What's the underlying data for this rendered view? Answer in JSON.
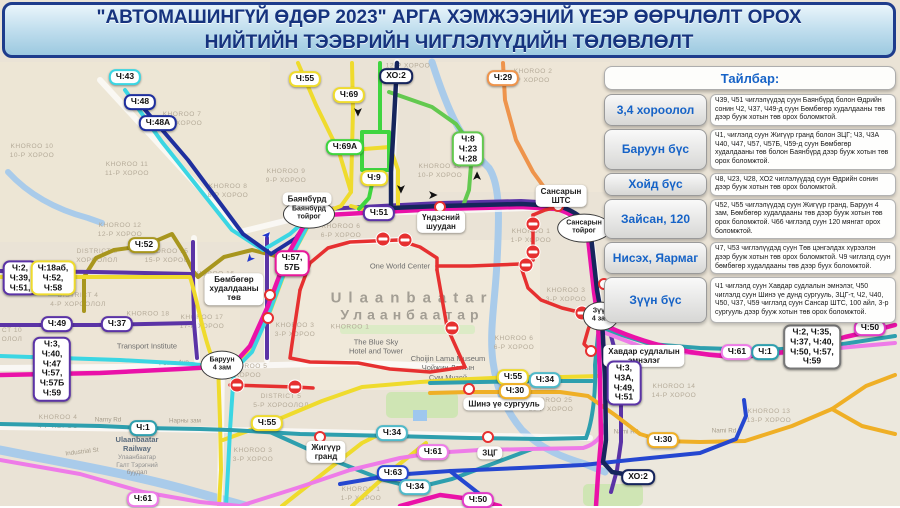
{
  "title": {
    "line1": "\"АВТОМАШИНГҮЙ ӨДӨР 2023\" АРГА ХЭМЖЭЭНИЙ ҮЕЭР ӨӨРЧЛӨЛТ ОРОХ",
    "line2": "НИЙТИЙН ТЭЭВРИЙН ЧИГЛЭЛҮҮДИЙН ТӨЛӨВЛӨЛТ"
  },
  "legend": {
    "header": "Тайлбар:",
    "rows": [
      {
        "label": "3,4 хороолол",
        "text": "Ч39, Ч51 чиглэлүүдэд суун Баянбүрд болон Өдрийн сонин Ч2, Ч37, Ч49-д суун Бөмбөгөр худалдааны төв дээр бууж хотын төв орох боломжтой."
      },
      {
        "label": "Баруун бүс",
        "text": "Ч1, чиглэлд суун Жигүүр гранд болон ЗЦГ; Ч3, Ч3А Ч40, Ч47, Ч57, Ч57Б, Ч59-д суун Бөмбөгөр худалдааны төв болон Баянбүрд дээр бууж хотын төв орох боломжтой."
      },
      {
        "label": "Хойд бүс",
        "text": "Ч8, Ч23, Ч28, ХО2 чиглэлүүдэд суун Өдрийн сонин дээр бууж хотын төв орох боломжтой."
      },
      {
        "label": "Зайсан, 120",
        "text": "Ч52, Ч55 чиглэлүүдэд суун Жигүүр гранд, Баруун 4 зам, Бөмбөгөр худалдааны төв дээр бууж хотын төв орох боломжтой. Ч66 чиглэлд суун 120 мянгат орох боломжтой."
      },
      {
        "label": "Нисэх, Яармаг",
        "text": "Ч7, Ч53 чиглэлүүдэд суун Төв цэнгэлдэх хүрээлэн дээр бууж хотын төв орох боломжтой. Ч9 чиглэлд суун бөмбөгөр худалдааны төв дээр буух боломжтой."
      },
      {
        "label": "Зүүн бүс",
        "text": "Ч1 чиглэлд суун Хавдар судлалын эмнэлэг, Ч50 чиглэлд суун Шинэ үе дунд сургууль, ЗЦГ-т, Ч2, Ч40, Ч50, Ч37, Ч59 чиглэлд суун Сансар ШТС, 100 айл, 3-р сургууль дээр бууж хотын төв орох боломжтой."
      }
    ]
  },
  "map": {
    "city": {
      "en": "Ulaanbaatar",
      "mn": "Улаанбаатар",
      "x": 412,
      "y": 306
    },
    "route_colors": {
      "Ч43": "#3BD6E3",
      "Ч48": "#1F2F9E",
      "Ч48А": "#1F2F9E",
      "Ч55": "#EFDB2D",
      "Ч69": "#EFDB2D",
      "ХО2": "#16255C",
      "Ч29": "#EE944C",
      "Ч69А": "#3FD53F",
      "Ч8-Ч23-Ч28": "#63C94F",
      "Ч9": "#EFDB2D",
      "Ч51": "#5B33A6",
      "Ч52": "#A8961E",
      "Ч57-57Б": "#E8189A",
      "Ч1": "#2E9FAE",
      "Ч34": "#4FB9C9",
      "Ч61": "#EE7BE8",
      "Ч30": "#EFAF26",
      "Ч63": "#2547D0",
      "Ч50": "#E23CC8",
      "restricted_zone": "#E63030",
      "river": "#A9CBEA",
      "map_bg": "#EAE3D6",
      "legend_label": "#1663C7",
      "title_text": "#16337E"
    },
    "route_badges": [
      {
        "label": "Ч:43",
        "lines": [
          "Ч:43"
        ],
        "color": "#3BD6E3",
        "x": 125,
        "y": 77
      },
      {
        "label": "Ч:48",
        "lines": [
          "Ч:48"
        ],
        "color": "#1F2F9E",
        "x": 140,
        "y": 102
      },
      {
        "label": "Ч:48А",
        "lines": [
          "Ч:48А"
        ],
        "color": "#1F2F9E",
        "x": 158,
        "y": 123
      },
      {
        "label": "Ч:55",
        "lines": [
          "Ч:55"
        ],
        "color": "#EFDB2D",
        "x": 305,
        "y": 79
      },
      {
        "label": "Ч:69",
        "lines": [
          "Ч:69"
        ],
        "color": "#EFDB2D",
        "x": 349,
        "y": 95
      },
      {
        "label": "ХО:2",
        "lines": [
          "ХО:2"
        ],
        "color": "#16255C",
        "x": 396,
        "y": 76
      },
      {
        "label": "Ч:29",
        "lines": [
          "Ч:29"
        ],
        "color": "#EE944C",
        "x": 503,
        "y": 78
      },
      {
        "label": "Ч:69А",
        "lines": [
          "Ч:69А"
        ],
        "color": "#3FD53F",
        "x": 345,
        "y": 147
      },
      {
        "label": "Ч:9",
        "lines": [
          "Ч:9"
        ],
        "color": "#EFDB2D",
        "x": 374,
        "y": 178
      },
      {
        "label": "Ч:8 Ч:23 Ч:28",
        "lines": [
          "Ч:8",
          "Ч:23",
          "Ч:28"
        ],
        "color": "#63C94F",
        "x": 468,
        "y": 149
      },
      {
        "label": "Ч:51",
        "lines": [
          "Ч:51"
        ],
        "color": "#5B33A6",
        "x": 379,
        "y": 213
      },
      {
        "label": "Ч:52",
        "lines": [
          "Ч:52"
        ],
        "color": "#A8961E",
        "x": 144,
        "y": 245
      },
      {
        "label": "Ч:2 Ч:39 Ч:51",
        "lines": [
          "Ч:2,",
          "Ч:39,",
          "Ч:51,"
        ],
        "color": "#5B33A6",
        "x": 20,
        "y": 278
      },
      {
        "label": "Ч:18аб Ч:52 Ч:58",
        "lines": [
          "Ч:18аб,",
          "Ч:52,",
          "Ч:58"
        ],
        "color": "#EFDB2D",
        "x": 53,
        "y": 278
      },
      {
        "label": "Ч:57 57Б",
        "lines": [
          "Ч:57,",
          "57Б"
        ],
        "color": "#E8189A",
        "x": 292,
        "y": 263
      },
      {
        "label": "Ч:49",
        "lines": [
          "Ч:49"
        ],
        "color": "#5B33A6",
        "x": 57,
        "y": 324
      },
      {
        "label": "Ч:37",
        "lines": [
          "Ч:37"
        ],
        "color": "#5B33A6",
        "x": 117,
        "y": 324
      },
      {
        "label": "Ч:3 Ч:40 Ч:47 Ч:57 Ч:57Б Ч:59",
        "lines": [
          "Ч:3,",
          "Ч:40,",
          "Ч:47",
          "Ч:57,",
          "Ч:57Б",
          "Ч:59"
        ],
        "color": "#5B33A6",
        "x": 52,
        "y": 369
      },
      {
        "label": "Ч:1",
        "lines": [
          "Ч:1"
        ],
        "color": "#2E9FAE",
        "x": 143,
        "y": 428
      },
      {
        "label": "Ч:55",
        "lines": [
          "Ч:55"
        ],
        "color": "#EFDB2D",
        "x": 267,
        "y": 423
      },
      {
        "label": "Ч:34",
        "lines": [
          "Ч:34"
        ],
        "color": "#4FB9C9",
        "x": 392,
        "y": 433
      },
      {
        "label": "Ч:61",
        "lines": [
          "Ч:61"
        ],
        "color": "#EE7BE8",
        "x": 433,
        "y": 452
      },
      {
        "label": "Ч:63",
        "lines": [
          "Ч:63"
        ],
        "color": "#2547D0",
        "x": 393,
        "y": 473
      },
      {
        "label": "Ч:34",
        "lines": [
          "Ч:34"
        ],
        "color": "#4FB9C9",
        "x": 415,
        "y": 487
      },
      {
        "label": "Ч:50",
        "lines": [
          "Ч:50"
        ],
        "color": "#E23CC8",
        "x": 478,
        "y": 500
      },
      {
        "label": "Ч:61",
        "lines": [
          "Ч:61"
        ],
        "color": "#EE7BE8",
        "x": 143,
        "y": 499
      },
      {
        "label": "Ч:55",
        "lines": [
          "Ч:55"
        ],
        "color": "#EFDB2D",
        "x": 513,
        "y": 377
      },
      {
        "label": "Ч:34",
        "lines": [
          "Ч:34"
        ],
        "color": "#4FB9C9",
        "x": 545,
        "y": 380
      },
      {
        "label": "Ч:30",
        "lines": [
          "Ч:30"
        ],
        "color": "#EFAF26",
        "x": 515,
        "y": 391
      },
      {
        "label": "Ч:30",
        "lines": [
          "Ч:30"
        ],
        "color": "#EFAF26",
        "x": 663,
        "y": 440
      },
      {
        "label": "ХО:2",
        "lines": [
          "ХО:2"
        ],
        "color": "#16255C",
        "x": 638,
        "y": 477
      },
      {
        "label": "Ч:61",
        "lines": [
          "Ч:61"
        ],
        "color": "#EE7BE8",
        "x": 737,
        "y": 352
      },
      {
        "label": "Ч:1",
        "lines": [
          "Ч:1"
        ],
        "color": "#2E9FAE",
        "x": 765,
        "y": 352
      },
      {
        "label": "Ч:2 Ч:35 Ч:37 Ч:40 Ч:50 Ч:57 Ч:59",
        "lines": [
          "Ч:2, Ч:35,",
          "Ч:37, Ч:40,",
          "Ч:50, Ч:57,",
          "Ч:59"
        ],
        "color": "#777777",
        "x": 812,
        "y": 347
      },
      {
        "label": "Ч:50",
        "lines": [
          "Ч:50"
        ],
        "color": "#E23CC8",
        "x": 870,
        "y": 328
      },
      {
        "label": "Ч:3 Ч3А Ч:49 Ч:51",
        "lines": [
          "Ч:3,",
          "Ч3А,",
          "Ч:49,",
          "Ч:51"
        ],
        "color": "#5B33A6",
        "x": 624,
        "y": 383
      }
    ],
    "junctions": [
      {
        "lines": [
          "Баянбүрд",
          "тойрог"
        ],
        "x": 309,
        "y": 214
      },
      {
        "lines": [
          "Сансарын",
          "тойрог"
        ],
        "x": 584,
        "y": 228
      },
      {
        "lines": [
          "Зүүн",
          "4 зам"
        ],
        "x": 601,
        "y": 316
      },
      {
        "lines": [
          "Баруун",
          "4 зам"
        ],
        "x": 222,
        "y": 365
      }
    ],
    "places": [
      {
        "lines": [
          "Баянбүрд"
        ],
        "x": 307,
        "y": 199
      },
      {
        "lines": [
          "Үндэсний",
          "шуудан"
        ],
        "x": 441,
        "y": 222
      },
      {
        "lines": [
          "Сансарын",
          "ШТС"
        ],
        "x": 561,
        "y": 196
      },
      {
        "lines": [
          "Бөмбөгөр",
          "худалдааны",
          "төв"
        ],
        "x": 234,
        "y": 289
      },
      {
        "lines": [
          "Шинэ үе сургууль"
        ],
        "x": 504,
        "y": 404
      },
      {
        "lines": [
          "Хавдар судлалын",
          "эмнэлэг"
        ],
        "x": 644,
        "y": 356
      },
      {
        "lines": [
          "ЗЦГ"
        ],
        "x": 490,
        "y": 453
      },
      {
        "lines": [
          "Жигүүр",
          "гранд"
        ],
        "x": 326,
        "y": 452
      }
    ],
    "pois": [
      {
        "cls": "poi",
        "lines": [
          "One World Center"
        ],
        "x": 400,
        "y": 266
      },
      {
        "cls": "poi",
        "lines": [
          "The Blue Sky",
          "Hotel and Tower"
        ],
        "x": 376,
        "y": 347
      },
      {
        "cls": "poi",
        "lines": [
          "Choijin Lama Museum",
          "Чойжин Ламын",
          "Сүм Музей"
        ],
        "x": 448,
        "y": 368
      },
      {
        "cls": "poi",
        "lines": [
          "Transport Institute"
        ],
        "x": 147,
        "y": 346
      },
      {
        "cls": "poi poi-rail",
        "lines": [
          "Ulaanbaatar",
          "Railway"
        ],
        "sub": [
          "Улаанбаатар",
          "Галт Тэрэгний",
          "буудал"
        ],
        "x": 137,
        "y": 456
      }
    ],
    "areas": [
      {
        "en": "KHOROO 10",
        "mn": "10-Р ХОРОО",
        "x": 32,
        "y": 152
      },
      {
        "en": "KHOROO 11",
        "mn": "11-Р ХОРОО",
        "x": 127,
        "y": 170
      },
      {
        "en": "KHOROO 7",
        "mn": "7-Р ХОРОО",
        "x": 182,
        "y": 120
      },
      {
        "en": "KHOROO 8",
        "mn": "8-Р ХОРОО",
        "x": 228,
        "y": 192
      },
      {
        "en": "KHOROO 9",
        "mn": "9-Р ХОРОО",
        "x": 286,
        "y": 177
      },
      {
        "en": "",
        "mn": "12-Р ХОРОО",
        "x": 408,
        "y": 67
      },
      {
        "en": "KHOROO 10",
        "mn": "10-Р ХОРОО",
        "x": 440,
        "y": 172
      },
      {
        "en": "KHOROO 2",
        "mn": "Р ХОРОО",
        "x": 533,
        "y": 77
      },
      {
        "en": "KHOROO 12",
        "mn": "12-Р ХОРОО",
        "x": 120,
        "y": 231
      },
      {
        "en": "DISTRICT 3",
        "mn": "ХОРООЛОЛ",
        "x": 97,
        "y": 257
      },
      {
        "en": "KHOROO 15",
        "mn": "15-Р ХОРОО",
        "x": 167,
        "y": 257
      },
      {
        "en": "KHOROO 16",
        "mn": "",
        "x": 213,
        "y": 275
      },
      {
        "en": "DISTRICT 4",
        "mn": "4-Р ХОРООЛОЛ",
        "x": 78,
        "y": 301
      },
      {
        "en": "KHOROO 18",
        "mn": "",
        "x": 148,
        "y": 315
      },
      {
        "en": "KHOROO 17",
        "mn": "17-Р ХОРОО",
        "x": 202,
        "y": 323
      },
      {
        "en": "KHOROO 3",
        "mn": "3-Р ХОРОО",
        "x": 295,
        "y": 331
      },
      {
        "en": "CT 10",
        "mn": "ОЛОЛ",
        "x": 12,
        "y": 336
      },
      {
        "en": "KHOROO 4",
        "mn": "4-Р ХОРОО",
        "x": 58,
        "y": 423
      },
      {
        "en": "KHOROO 5",
        "mn": "ХОРОО",
        "x": 248,
        "y": 372
      },
      {
        "en": "DISTRICT 5",
        "mn": "5-Р ХОРООЛОЛ",
        "x": 281,
        "y": 402
      },
      {
        "en": "KHOROO 3",
        "mn": "3-Р ХОРОО",
        "x": 253,
        "y": 456
      },
      {
        "en": "KHOROO 1",
        "mn": "1-Р ХОРОО",
        "x": 361,
        "y": 495
      },
      {
        "en": "KHOROO 6",
        "mn": "6-Р ХОРОО",
        "x": 341,
        "y": 232
      },
      {
        "en": "KHOROO 1",
        "mn": "",
        "x": 350,
        "y": 328
      },
      {
        "en": "KHOROO 1",
        "mn": "1-Р ХОРОО",
        "x": 531,
        "y": 237
      },
      {
        "en": "KHOROO 3",
        "mn": "3-Р ХОРОО",
        "x": 566,
        "y": 296
      },
      {
        "en": "KHOROO 6",
        "mn": "6-Р ХОРОО",
        "x": 514,
        "y": 344
      },
      {
        "en": "KHOROO 25",
        "mn": "25-Р ХОРОО",
        "x": 551,
        "y": 406
      },
      {
        "en": "KHOROO 14",
        "mn": "14-Р ХОРОО",
        "x": 674,
        "y": 392
      },
      {
        "en": "KHOROO 13",
        "mn": "13-Р ХОРОО",
        "x": 769,
        "y": 417
      },
      {
        "en": "",
        "mn": "15-Р ХОРОО",
        "x": 764,
        "y": 305
      }
    ],
    "roads": [
      {
        "t": "Peace Ave",
        "x": 174,
        "y": 363,
        "r": -3
      },
      {
        "t": "Narny Rd",
        "x": 108,
        "y": 420
      },
      {
        "t": "Нарны зам",
        "x": 185,
        "y": 421
      },
      {
        "t": "Nami Rd",
        "x": 626,
        "y": 432
      },
      {
        "t": "Nami Rd",
        "x": 724,
        "y": 431
      },
      {
        "t": "Industrial St",
        "x": 82,
        "y": 452,
        "r": -7
      }
    ],
    "stops": [
      [
        318,
        221
      ],
      [
        440,
        207
      ],
      [
        558,
        206
      ],
      [
        270,
        295
      ],
      [
        268,
        318
      ],
      [
        320,
        437
      ],
      [
        488,
        437
      ],
      [
        469,
        389
      ],
      [
        591,
        351
      ],
      [
        604,
        284
      ],
      [
        222,
        358
      ]
    ],
    "no_entry": [
      [
        383,
        239
      ],
      [
        405,
        240
      ],
      [
        526,
        265
      ],
      [
        533,
        224
      ],
      [
        533,
        252
      ],
      [
        582,
        313
      ],
      [
        452,
        328
      ],
      [
        237,
        385
      ],
      [
        295,
        387
      ]
    ],
    "arrows": [
      {
        "x": 357,
        "y": 112,
        "r": 90
      },
      {
        "x": 400,
        "y": 189,
        "r": 90
      },
      {
        "x": 433,
        "y": 196,
        "r": 0
      },
      {
        "x": 478,
        "y": 176,
        "r": -90
      }
    ],
    "arrows_blue": [
      {
        "x": 268,
        "y": 236,
        "r": -48
      },
      {
        "x": 249,
        "y": 258,
        "r": 132
      }
    ]
  }
}
